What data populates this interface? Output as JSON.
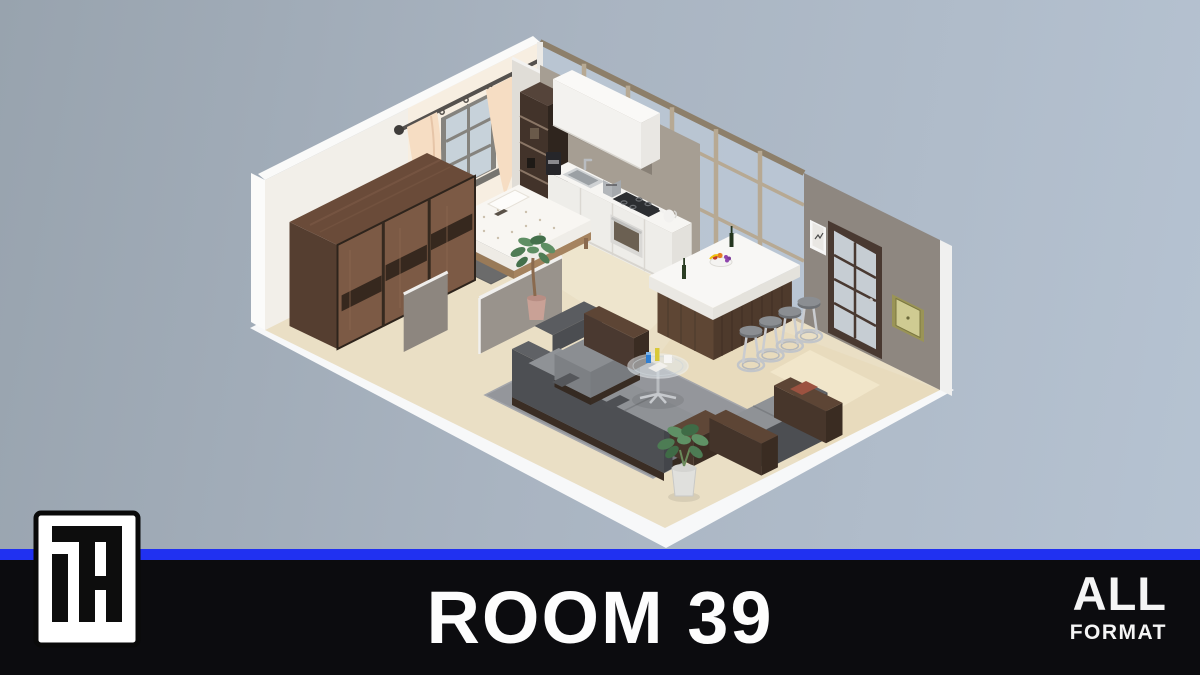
{
  "meta": {
    "description": "3D isometric cutaway render of a studio apartment, thumbnail card"
  },
  "footer": {
    "title": "ROOM 39",
    "format_badge": {
      "line1": "ALL",
      "line2": "FORMAT"
    },
    "logo_monogram": "TH"
  },
  "colors": {
    "accent_blue": "#2031f1",
    "footer_bg": "#0c0c0f",
    "bg_left": "#98a3ae",
    "bg_right": "#b6c3d2",
    "floor_beige": "#eadfc5",
    "wall_white": "#f2efe9",
    "wall_gray": "#8e8780",
    "glass_tint": "#bac7d4",
    "kitchen_wall": "#a69e93",
    "wood_wardrobe": "#7c5a45",
    "wood_island": "#5e4634",
    "sofa_gray": "#8f9296",
    "sofa_dark": "#4d4f53",
    "curtain_peach": "#f6ddc3",
    "rug_gray": "#94969b"
  },
  "scene": {
    "label": "Room 39 isometric interior",
    "areas": [
      "bedroom",
      "wardrobe",
      "kitchen",
      "bar island",
      "living room",
      "entry"
    ],
    "furniture": [
      "sliding-door wardrobe",
      "bed with dotted duvet",
      "curtained window",
      "floor-to-ceiling glass wall",
      "white kitchen cabinets with appliances",
      "kitchen island with 4 chrome bar stools",
      "gray sectional sofa",
      "loveseat",
      "round glass coffee table",
      "potted plants",
      "french glass door",
      "two picture frames"
    ]
  }
}
